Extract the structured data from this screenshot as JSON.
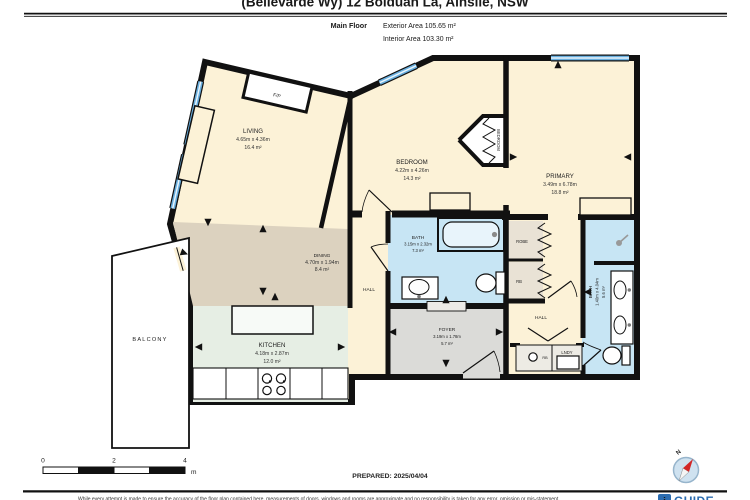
{
  "title": {
    "address": "(Bellevarde Wy) 12 Bolduan La, Ainslie, NSW"
  },
  "header": {
    "floor": "Main Floor",
    "exterior": "Exterior Area 105.65 m²",
    "interior": "Interior Area 103.30 m²"
  },
  "rooms": {
    "living": {
      "name": "LIVING",
      "dims": "4.65m x 4.36m",
      "area": "16.4 m²"
    },
    "dining": {
      "name": "DINING",
      "dims": "4.70m x 1.94m",
      "area": "8.4 m²"
    },
    "kitchen": {
      "name": "KITCHEN",
      "dims": "4.18m x 2.87m",
      "area": "12.0 m²"
    },
    "bedroom": {
      "name": "BEDROOM",
      "dims": "4.22m x 4.26m",
      "area": "14.3 m²"
    },
    "primary": {
      "name": "PRIMARY",
      "dims": "3.49m x 6.78m",
      "area": "18.8 m²"
    },
    "bath_main": {
      "name": "BATH",
      "dims": "3.15m x 2.32m",
      "area": "7.3 m²"
    },
    "bath_ensuite": {
      "name": "BATH",
      "dims": "1.40m x 4.04m",
      "area": "5.6 m²"
    },
    "foyer": {
      "name": "FOYER",
      "dims": "3.19m x 1.78m",
      "area": "5.7 m²"
    }
  },
  "labels": {
    "hall_center": "HALL",
    "hall_rear": "HALL",
    "balcony": "BALCONY",
    "robe": "ROBE",
    "rb": "RB",
    "rb_small": "RB",
    "lndy": "LNDY",
    "fireplace": "F/P",
    "bedroom_robe": "BEDROOM"
  },
  "scalebar": {
    "t0": "0",
    "t2": "2",
    "t4": "4",
    "unit": "m"
  },
  "footer": {
    "prepared": "PREPARED: 2025/04/04",
    "compass_n": "N",
    "logo_mark": "i",
    "logo_text": "GUIDE",
    "disclaimer": "While every attempt is made to ensure the accuracy of the floor plan contained here, measurements of doors, windows and rooms are approximate and no responsibility is taken for any error, omission or mis-statement."
  }
}
